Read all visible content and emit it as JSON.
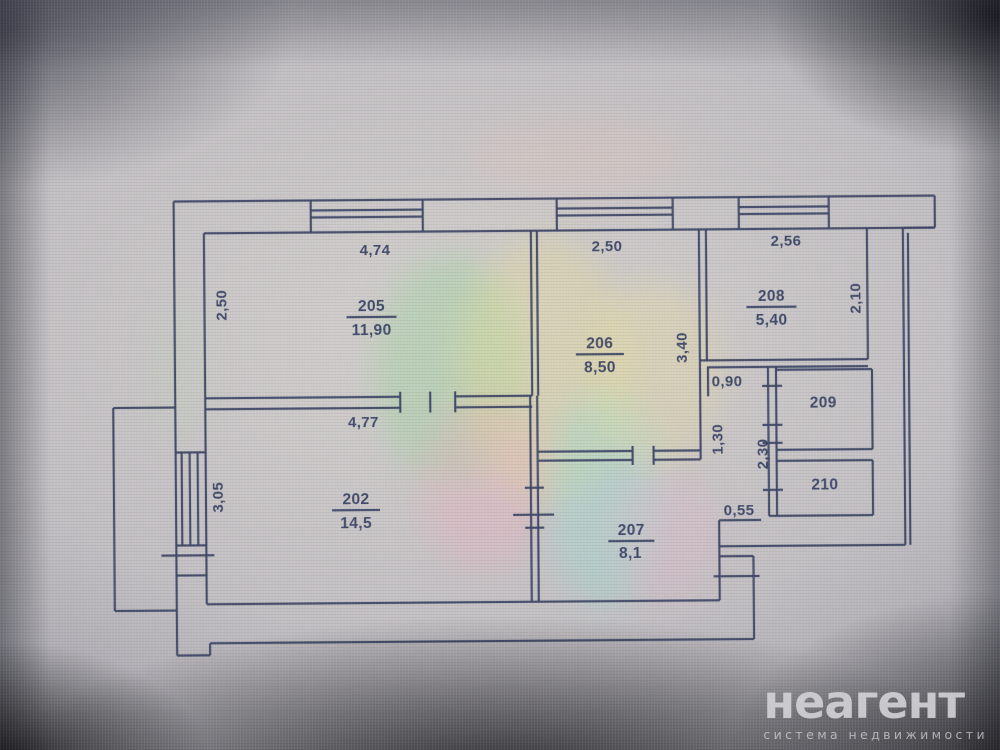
{
  "colors": {
    "line": "#3c4565",
    "text": "#333e61",
    "wm": "#d6d6da"
  },
  "watermark": {
    "brand": "неагент",
    "tagline": "система недвижимости"
  },
  "plan": {
    "rooms": [
      {
        "number": "205",
        "area": "11,90"
      },
      {
        "number": "206",
        "area": "8,50"
      },
      {
        "number": "208",
        "area": "5,40"
      },
      {
        "number": "202",
        "area": "14,5"
      },
      {
        "number": "207",
        "area": "8,1"
      },
      {
        "number": "209",
        "area": ""
      },
      {
        "number": "210",
        "area": ""
      }
    ],
    "dims": {
      "room205_width": "4,74",
      "room205_height": "2,50",
      "room206_width": "2,50",
      "room206_height": "3,40",
      "room208_width": "2,56",
      "room208_height": "2,10",
      "room202_width": "4,77",
      "room202_height": "3,05",
      "passage_width": "0,90",
      "corridor_depth1": "1,30",
      "corridor_depth2": "2,30",
      "hall_niche": "0,55"
    }
  }
}
